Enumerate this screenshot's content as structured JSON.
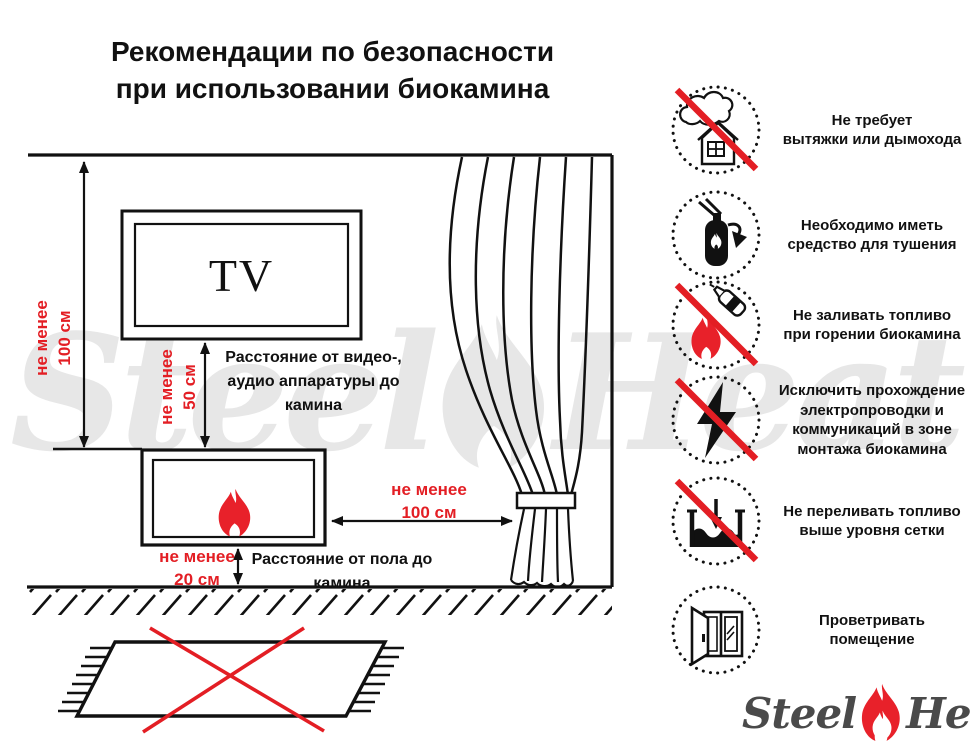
{
  "title": {
    "line1": "Рекомендации по безопасности",
    "line2": "при использовании биокамина"
  },
  "diagram": {
    "tv_label": "TV",
    "dim_wall": "не менее\n100 см",
    "dim_tv": "не менее\n50 см",
    "cap_tv": "Расстояние от видео-,\nаудио аппаратуры до\nкамина",
    "dim_curtain": "не менее\n100 см",
    "dim_floor": "не менее\n20 см",
    "cap_floor": "Расстояние от пола до\nкамина"
  },
  "icons": [
    {
      "name": "no-chimney",
      "prohibited": true,
      "caption": "Не требует\nвытяжки или дымохода"
    },
    {
      "name": "extinguisher",
      "prohibited": false,
      "caption": "Необходимо иметь\nсредство для тушения"
    },
    {
      "name": "no-refill-while-burning",
      "prohibited": true,
      "caption": "Не заливать топливо\nпри горении биокамина"
    },
    {
      "name": "no-electrical-wiring",
      "prohibited": true,
      "caption": "Исключить прохождение\nэлектропроводки и\nкоммуникаций в зоне\nмонтажа биокамина"
    },
    {
      "name": "no-overfill",
      "prohibited": true,
      "caption": "Не переливать топливо\nвыше уровня сетки"
    },
    {
      "name": "ventilate-room",
      "prohibited": false,
      "caption": "Проветривать\nпомещение"
    }
  ],
  "watermark": {
    "steel": "Steel",
    "heat": "Heat"
  },
  "logo": {
    "steel": "Steel",
    "heat": "Heat"
  },
  "colors": {
    "accent_red": "#e31e24",
    "flame_red": "#e8212a",
    "ink": "#111111",
    "watermark_gray": "#e7e7e7",
    "logo_gray": "#4a4a4a"
  }
}
